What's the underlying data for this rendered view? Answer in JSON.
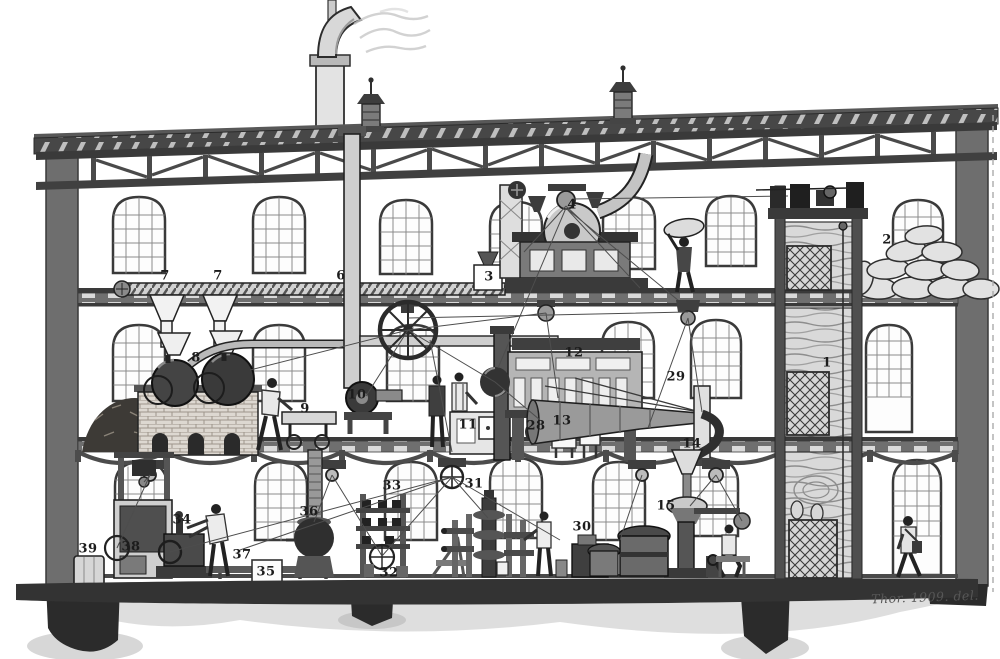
{
  "figure": {
    "kind": "sectional engraving of a three-story factory with numbered machinery",
    "paper_color": "#ffffff",
    "ink_color": "#2d2d2d",
    "signature": "Thor. 1909. del.",
    "labels": [
      {
        "n": "7",
        "x": 165,
        "y": 276
      },
      {
        "n": "7",
        "x": 218,
        "y": 276
      },
      {
        "n": "6",
        "x": 341,
        "y": 276
      },
      {
        "n": "3",
        "x": 489,
        "y": 277
      },
      {
        "n": "4",
        "x": 572,
        "y": 205
      },
      {
        "n": "2",
        "x": 887,
        "y": 240
      },
      {
        "n": "8",
        "x": 196,
        "y": 358
      },
      {
        "n": "10",
        "x": 357,
        "y": 395
      },
      {
        "n": "9",
        "x": 305,
        "y": 409
      },
      {
        "n": "11",
        "x": 468,
        "y": 425
      },
      {
        "n": "12",
        "x": 574,
        "y": 353
      },
      {
        "n": "28",
        "x": 536,
        "y": 426
      },
      {
        "n": "13",
        "x": 562,
        "y": 421
      },
      {
        "n": "29",
        "x": 676,
        "y": 377
      },
      {
        "n": "14",
        "x": 692,
        "y": 444
      },
      {
        "n": "1",
        "x": 827,
        "y": 363
      },
      {
        "n": "39",
        "x": 88,
        "y": 549
      },
      {
        "n": "38",
        "x": 131,
        "y": 547
      },
      {
        "n": "34",
        "x": 182,
        "y": 520
      },
      {
        "n": "37",
        "x": 242,
        "y": 555
      },
      {
        "n": "36",
        "x": 309,
        "y": 512
      },
      {
        "n": "35",
        "x": 266,
        "y": 572
      },
      {
        "n": "33",
        "x": 392,
        "y": 486
      },
      {
        "n": "32",
        "x": 389,
        "y": 573
      },
      {
        "n": "31",
        "x": 474,
        "y": 484
      },
      {
        "n": "30",
        "x": 582,
        "y": 527
      },
      {
        "n": "15",
        "x": 666,
        "y": 506
      }
    ]
  }
}
